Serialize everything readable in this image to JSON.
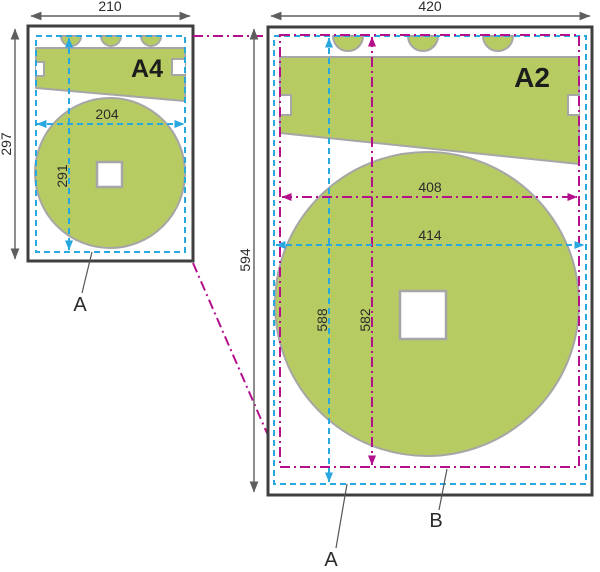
{
  "a4_sheet": {
    "name": "A4",
    "paper_width": "210",
    "paper_height": "297",
    "print_width": "204",
    "print_height": "291",
    "print_area_marker": "A"
  },
  "a2_sheet": {
    "name": "A2",
    "paper_width": "420",
    "paper_height": "594",
    "print_width": "414",
    "print_height": "588",
    "scaled_width": "408",
    "scaled_height": "582",
    "print_area_marker": "A",
    "scaled_image_marker": "B"
  },
  "colors": {
    "test_pattern_green": "#b6cc62",
    "shape_outline_gray": "#a6a6a6",
    "paper_border": "#3f3f3f",
    "print_area_cyan": "#29a8e0",
    "scaled_area_magenta": "#b5108c",
    "dimension_gray": "#5e5e5e",
    "text_dark": "#2b2b2b"
  }
}
